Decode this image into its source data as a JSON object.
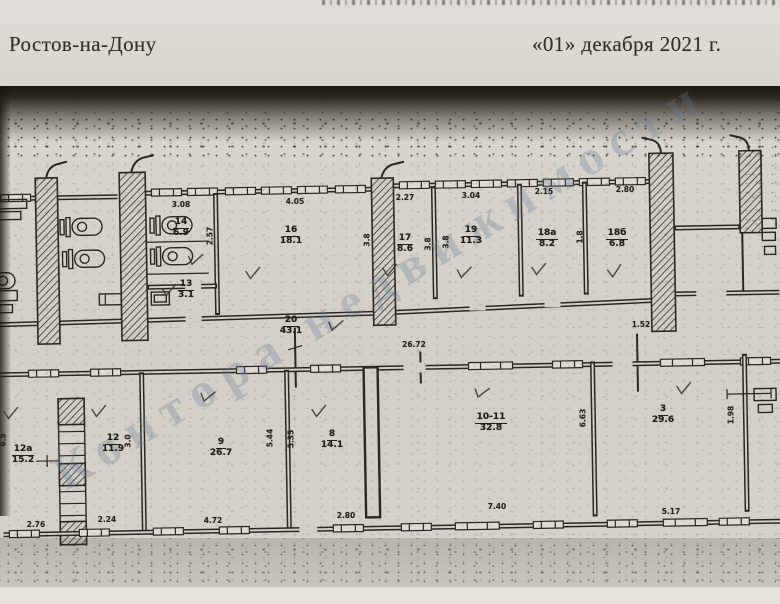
{
  "document": {
    "city": "Ростов-на-Дону",
    "date": "«01» декабря 2021 г."
  },
  "watermark": {
    "text": "Контора недвижимости"
  },
  "plan": {
    "rooms": [
      {
        "id": "room-14",
        "number": "14",
        "area": "6.9"
      },
      {
        "id": "room-13",
        "number": "13",
        "area": "3.1"
      },
      {
        "id": "room-16",
        "number": "16",
        "area": "18.1"
      },
      {
        "id": "room-17",
        "number": "17",
        "area": "8.6"
      },
      {
        "id": "room-19",
        "number": "19",
        "area": "11.3"
      },
      {
        "id": "room-18a",
        "number": "18а",
        "area": "8.2"
      },
      {
        "id": "room-18b",
        "number": "18б",
        "area": "6.8"
      },
      {
        "id": "corridor-20",
        "number": "20",
        "area": "43.1"
      },
      {
        "id": "room-12a",
        "number": "12а",
        "area": "15.2"
      },
      {
        "id": "room-12",
        "number": "12",
        "area": "11.9"
      },
      {
        "id": "room-9",
        "number": "9",
        "area": "26.7"
      },
      {
        "id": "room-8",
        "number": "8",
        "area": "14.1"
      },
      {
        "id": "room-10-11",
        "number": "10-11",
        "area": "32.8"
      },
      {
        "id": "room-3",
        "number": "3",
        "area": "29.6"
      }
    ],
    "dims": {
      "d1": "3.08",
      "d2": "4.05",
      "d3": "2.27",
      "d4": "3.04",
      "d5": "2.15",
      "d6": "2.80",
      "d7": "26.72",
      "d8": "1.52",
      "d9": "2.76",
      "d10": "2.24",
      "d11": "4.72",
      "d12": "2.80",
      "d13": "7.40",
      "d14": "5.17",
      "v1": "2.57",
      "v2": "3.8",
      "v3": "3.8",
      "v4": "3.8",
      "v5": "1.8",
      "v6": "6.5",
      "v7": "3.0",
      "v8": "5.44",
      "v9": "5.35",
      "v10": "6.63",
      "v11": "1.98"
    }
  }
}
